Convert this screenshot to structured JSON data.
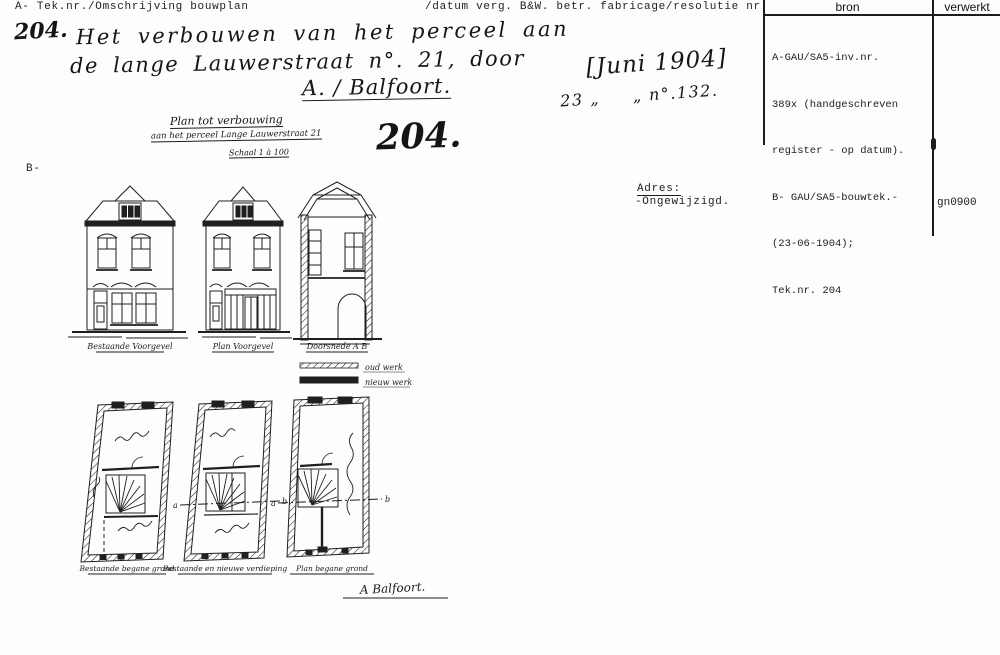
{
  "header": {
    "left": "A- Tek.nr./Omschrijving bouwplan",
    "right": "/datum verg. B&W. betr. fabricage/resolutie nr."
  },
  "source_table": {
    "col_bron": "bron",
    "col_verwerkt": "verwerkt",
    "bron_lines": [
      "A-GAU/SA5-inv.nr.",
      "389x (handgeschreven",
      "register - op datum).",
      "B- GAU/SA5-bouwtek.-",
      "(23-06-1904);",
      "Tek.nr. 204"
    ],
    "verwerkt_value": "gn0900"
  },
  "handwritten": {
    "number": "204.",
    "line1": "Het verbouwen van het perceel aan",
    "line2": "de lange Lauwerstraat n°. 21, door",
    "line3": "A. / Balfoort.",
    "date_bracket": "[Juni 1904]",
    "date_line": "23 „     „ n°.132.",
    "big_number": "204.",
    "plan_note_line1": "Plan tot verbouwing",
    "plan_note_line2": "aan het perceel Lange Lauwerstraat 21",
    "plan_note_line3": "Schaal 1 à 100"
  },
  "section_b_label": "B-",
  "adres": {
    "label": "Adres:",
    "value": "-Ongewijzigd."
  },
  "drawing": {
    "captions": {
      "facade1": "Bestaande Voorgevel",
      "facade2": "Plan Voorgevel",
      "section": "Doorsnede A B",
      "plan1": "Bestaande begane grond",
      "plan2": "Bestaande en nieuwe verdieping",
      "plan3": "Plan begane grond"
    },
    "legend": {
      "old": "oud werk",
      "new": "nieuw werk"
    },
    "markers": {
      "a": "a",
      "b": "b"
    },
    "signature": "A Balfoort."
  }
}
